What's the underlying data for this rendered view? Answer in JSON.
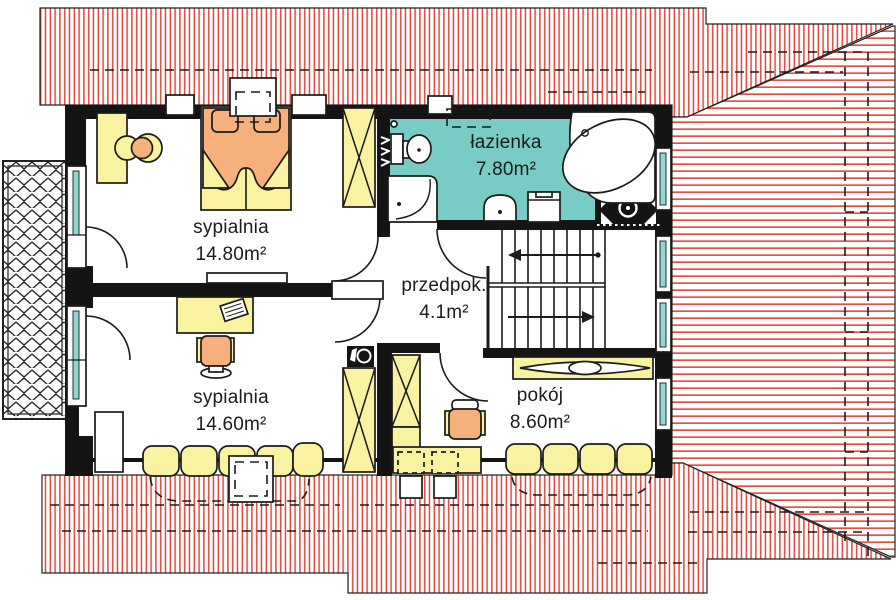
{
  "title": "rzut pietra - plan mieszkania",
  "rooms": [
    {
      "key": "bedroom-1",
      "label": "sypialnia",
      "area": "14.80m²"
    },
    {
      "key": "bathroom",
      "label": "łazienka",
      "area": "7.80m²"
    },
    {
      "key": "hallway",
      "label": "przedpok.",
      "area": "4.1m²"
    },
    {
      "key": "bedroom-2",
      "label": "sypialnia",
      "area": "14.60m²"
    },
    {
      "key": "room",
      "label": "pokój",
      "area": "8.60m²"
    }
  ],
  "colors": {
    "roof_red": "#e63c30",
    "wall": "#141414",
    "bath": "#79cbc5",
    "yellow": "#f9f2a1",
    "orange": "#f5b07c",
    "glass": "#8fd8d2",
    "ink": "#1b1b1b"
  }
}
